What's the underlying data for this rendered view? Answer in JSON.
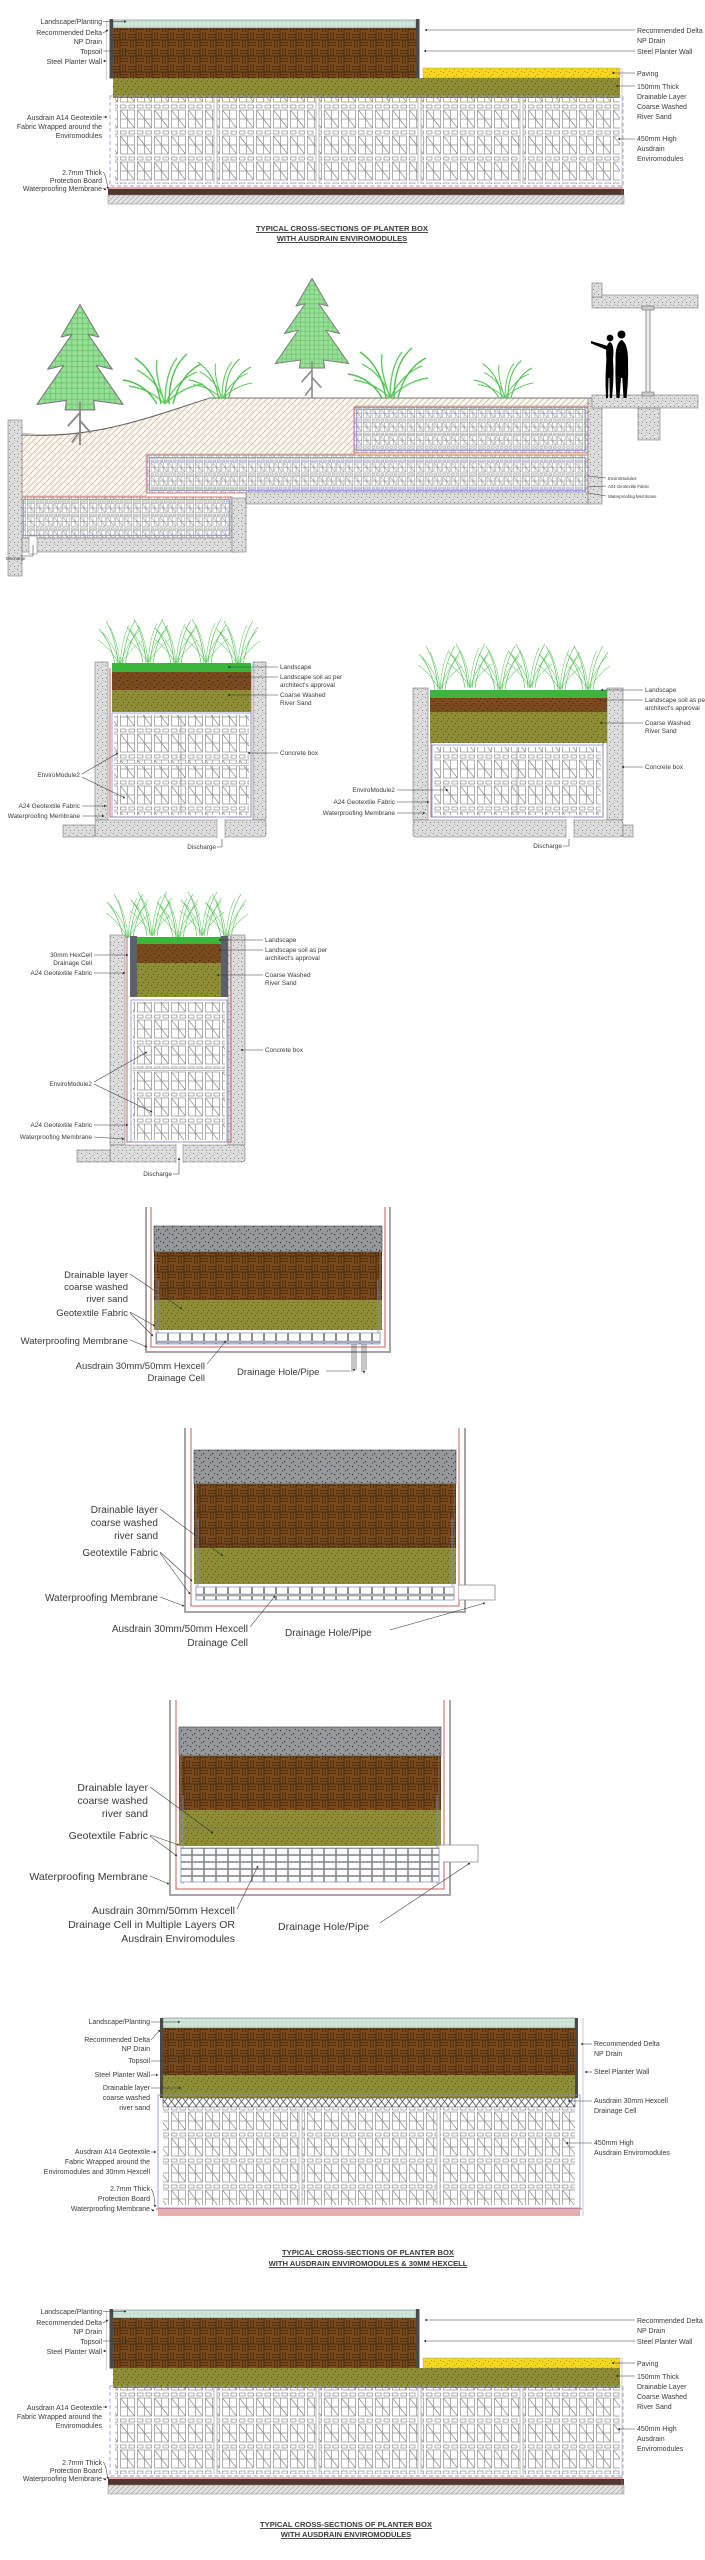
{
  "colors": {
    "topsoil_brown": "#7b4a1d",
    "sand_olive": "#8d8e35",
    "landscape_mint": "#d4e9dd",
    "landscape_green": "#3cb53d",
    "paving_yellow": "#f6d71f",
    "paving_gray": "#95999b",
    "concrete_gray": "#dedede",
    "waterproofing_red": "#cc5f5f",
    "geotextile_blue": "#8890d8",
    "protection_maroon": "#533630",
    "foliage_green": "#9ade9a"
  },
  "s1": {
    "left": [
      "Landscape/Planting",
      "Recommended Delta",
      "NP Drain",
      "Topsoil",
      "Steel Planter Wall",
      "Ausdrain A14 Geotextile",
      "Fabric Wrapped around the",
      "Enviromodules",
      "2.7mm Thick",
      "Protection Board",
      "Waterproofing Membrane"
    ],
    "right": [
      "Recommended Delta",
      "NP Drain",
      "Steel Planter Wall",
      "Paving",
      "150mm Thick",
      "Drainable Layer",
      "Coarse Washed",
      "River Sand",
      "450mm High",
      "Ausdrain",
      "Enviromodules"
    ],
    "title": [
      "TYPICAL CROSS-SECTIONS OF PLANTER BOX",
      "WITH AUSDRAIN ENVIROMODULES"
    ]
  },
  "s2": {
    "labels": [
      "EnviroModule2",
      "A24 Geotextile Fabric",
      "Waterproofing Membrane"
    ],
    "discharge": "Discharge"
  },
  "s3": {
    "right": [
      "Landscape",
      "Landscape soil as per",
      "architect's approval",
      "Coarse Washed",
      "River Sand",
      "Concrete box"
    ],
    "left": [
      "EnviroModule2",
      "A24 Geotextile Fabric",
      "Waterproofing Membrane"
    ],
    "discharge": "Discharge"
  },
  "s4": {
    "left": [
      "30mm HexCell",
      "Drainage Cell",
      "A24 Geotextile Fabric",
      "EnviroModule2",
      "A24 Geotextile Fabric",
      "Waterproofing Membrane"
    ],
    "right": [
      "Landscape",
      "Landscape soil as per",
      "architect's approval",
      "Coarse Washed",
      "River Sand",
      "Concrete box"
    ],
    "discharge": "Discharge"
  },
  "s5": {
    "lines": [
      "Drainable layer",
      "coarse washed",
      "river sand",
      "Geotextile Fabric",
      "Waterproofing Membrane",
      "Ausdrain 30mm/50mm Hexcell",
      "Drainage Cell",
      "Drainage Hole/Pipe"
    ]
  },
  "s6": {
    "lines": [
      "Drainable layer",
      "coarse washed",
      "river sand",
      "Geotextile Fabric",
      "Waterproofing Membrane",
      "Ausdrain 30mm/50mm Hexcell",
      "Drainage Cell",
      "Drainage Hole/Pipe"
    ]
  },
  "s7": {
    "lines": [
      "Drainable layer",
      "coarse washed",
      "river sand",
      "Geotextile Fabric",
      "Waterproofing Membrane",
      "Ausdrain 30mm/50mm Hexcell",
      "Drainage Cell in Multiple Layers OR",
      "Ausdrain Enviromodules",
      "Drainage Hole/Pipe"
    ]
  },
  "s8": {
    "left": [
      "Landscape/Planting",
      "Recommended Delta",
      "NP Drain",
      "Topsoil",
      "Steel Planter Wall",
      "Drainable layer",
      "coarse washed",
      "river sand",
      "Ausdrain A14 Geotextile",
      "Fabric Wrapped around the",
      "Enviromodules and 30mm Hexcell",
      "2.7mm Thick",
      "Protection Board",
      "Waterproofing Membrane"
    ],
    "right": [
      "Recommended Delta",
      "NP Drain",
      "Steel Planter Wall",
      "Ausdrain 30mm Hexcell",
      "Drainage Cell",
      "450mm High",
      "Ausdrain Enviromodules"
    ],
    "title": [
      "TYPICAL CROSS-SECTIONS OF PLANTER BOX",
      "WITH AUSDRAIN ENVIROMODULES & 30MM HEXCELL"
    ]
  },
  "s9": {
    "left": [
      "Landscape/Planting",
      "Recommended Delta",
      "NP Drain",
      "Topsoil",
      "Steel Planter Wall",
      "Ausdrain A14 Geotextile",
      "Fabric Wrapped around the",
      "Enviromodules",
      "2.7mm Thick",
      "Protection Board",
      "Waterproofing Membrane"
    ],
    "right": [
      "Recommended Delta",
      "NP Drain",
      "Steel Planter Wall",
      "Paving",
      "150mm Thick",
      "Drainable Layer",
      "Coarse Washed",
      "River Sand",
      "450mm High",
      "Ausdrain",
      "Enviromodules"
    ],
    "title": [
      "TYPICAL CROSS-SECTIONS OF PLANTER BOX",
      "WITH AUSDRAIN ENVIROMODULES"
    ]
  }
}
